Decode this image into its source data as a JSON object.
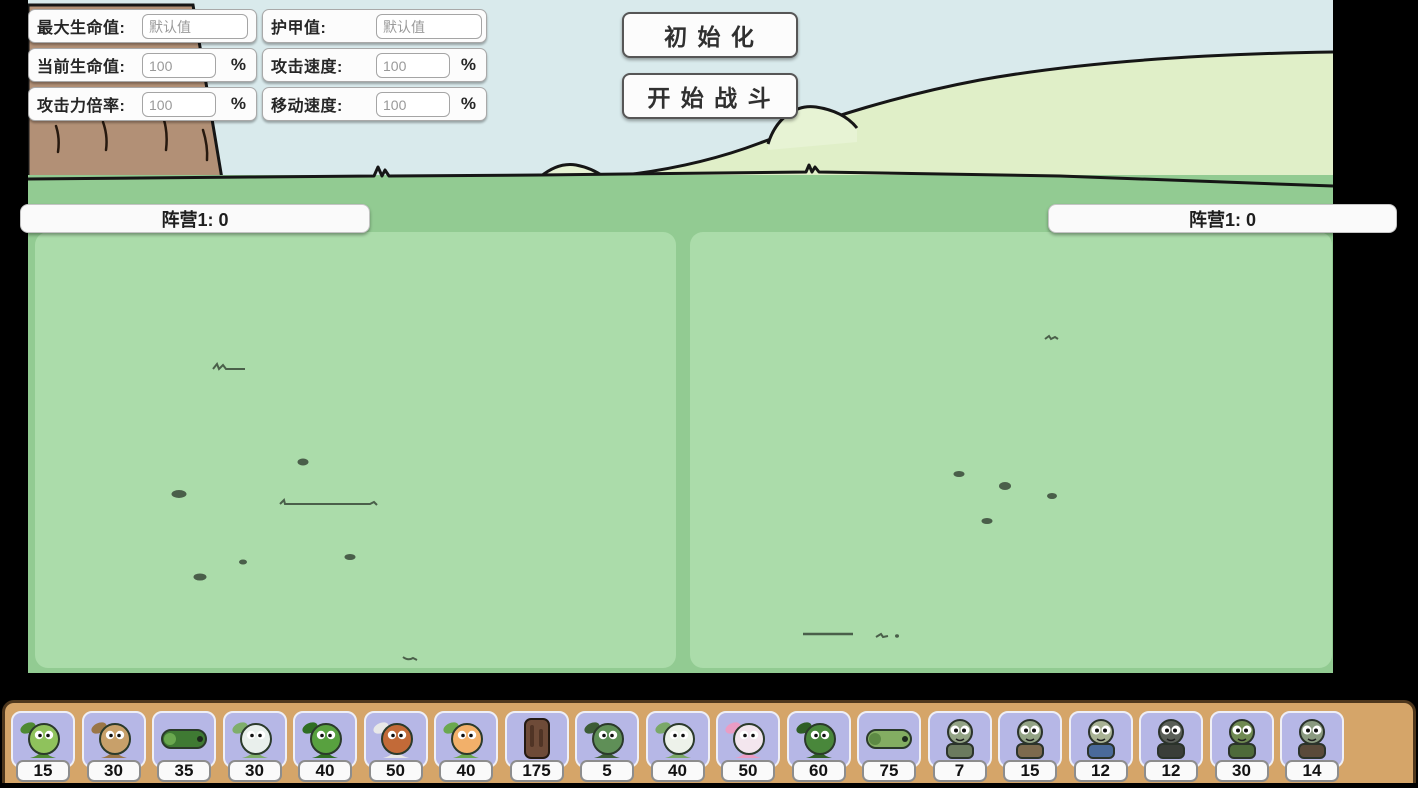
{
  "stats_panel": {
    "rows": [
      {
        "label": "最大生命值:",
        "value": "",
        "placeholder": "默认值",
        "suffix": ""
      },
      {
        "label": "当前生命值:",
        "value": "100",
        "placeholder": "",
        "suffix": "%"
      },
      {
        "label": "攻击力倍率:",
        "value": "100",
        "placeholder": "",
        "suffix": "%"
      },
      {
        "label": "护甲值:",
        "value": "",
        "placeholder": "默认值",
        "suffix": ""
      },
      {
        "label": "攻击速度:",
        "value": "100",
        "placeholder": "",
        "suffix": "%"
      },
      {
        "label": "移动速度:",
        "value": "100",
        "placeholder": "",
        "suffix": "%"
      }
    ]
  },
  "buttons": {
    "initialize": "初 始 化",
    "start_battle": "开 始 战 斗"
  },
  "scoreboards": {
    "left": "阵营1: 0",
    "right": "阵营1: 0"
  },
  "unit_bar": {
    "units": [
      {
        "icon": "peashooter-icon",
        "kind": "plant",
        "cost": "15",
        "body": "#8fc25c",
        "accent": "#4e8a33"
      },
      {
        "icon": "wallnut-icon",
        "kind": "plant",
        "cost": "30",
        "body": "#c8a06a",
        "accent": "#9a7648"
      },
      {
        "icon": "pea-cannon-icon",
        "kind": "wide",
        "cost": "35",
        "body": "#3f7a33",
        "accent": "#6aa84f"
      },
      {
        "icon": "iceberg-lettuce-icon",
        "kind": "plant",
        "cost": "30",
        "body": "#e9efec",
        "accent": "#7fae6b"
      },
      {
        "icon": "bonk-choy-icon",
        "kind": "plant",
        "cost": "40",
        "body": "#58a13f",
        "accent": "#2f6e23"
      },
      {
        "icon": "flag-plant-icon",
        "kind": "plant",
        "cost": "50",
        "body": "#c26a38",
        "accent": "#e8e8e8"
      },
      {
        "icon": "sprout-icon",
        "kind": "plant",
        "cost": "40",
        "body": "#f2b06a",
        "accent": "#6aa84f"
      },
      {
        "icon": "stump-icon",
        "kind": "object",
        "cost": "175",
        "body": "#6e4b38",
        "accent": "#503425"
      },
      {
        "icon": "bean-icon",
        "kind": "plant",
        "cost": "5",
        "body": "#5f8f57",
        "accent": "#3c5c36"
      },
      {
        "icon": "egg-plant-icon",
        "kind": "plant",
        "cost": "40",
        "body": "#edf2ea",
        "accent": "#7aa868"
      },
      {
        "icon": "mushroom-icon",
        "kind": "plant",
        "cost": "50",
        "body": "#f3e6ee",
        "accent": "#eb9cc4"
      },
      {
        "icon": "chomper-icon",
        "kind": "plant",
        "cost": "60",
        "body": "#49873b",
        "accent": "#2f5e26"
      },
      {
        "icon": "melon-icon",
        "kind": "wide",
        "cost": "75",
        "body": "#83ad62",
        "accent": "#5d8a44"
      },
      {
        "icon": "zombie-icon",
        "kind": "zombie",
        "cost": "7",
        "body": "#93a385",
        "accent": "#6b7a5e"
      },
      {
        "icon": "club-zombie-icon",
        "kind": "zombie",
        "cost": "15",
        "body": "#93a385",
        "accent": "#7d6a4e"
      },
      {
        "icon": "cap-zombie-icon",
        "kind": "zombie",
        "cost": "12",
        "body": "#a8b294",
        "accent": "#4a6a9a"
      },
      {
        "icon": "tv-zombie-icon",
        "kind": "zombie",
        "cost": "12",
        "body": "#5a5f58",
        "accent": "#3a3e38"
      },
      {
        "icon": "soldier-zombie-icon",
        "kind": "zombie",
        "cost": "30",
        "body": "#6f8a52",
        "accent": "#4e6a3a"
      },
      {
        "icon": "spear-zombie-icon",
        "kind": "zombie",
        "cost": "14",
        "body": "#8a9a80",
        "accent": "#5a4a3a"
      }
    ]
  },
  "colors": {
    "sky": "#d9eaec",
    "hill": "#e0efc8",
    "field_grass": "#92cb92",
    "battle_panel": "#abdcaa",
    "trunk": "#b29076",
    "unit_bar_bg": "#d5a569",
    "card_bg": "#b6b7e6",
    "panel_bg": "#fcfcfc"
  }
}
